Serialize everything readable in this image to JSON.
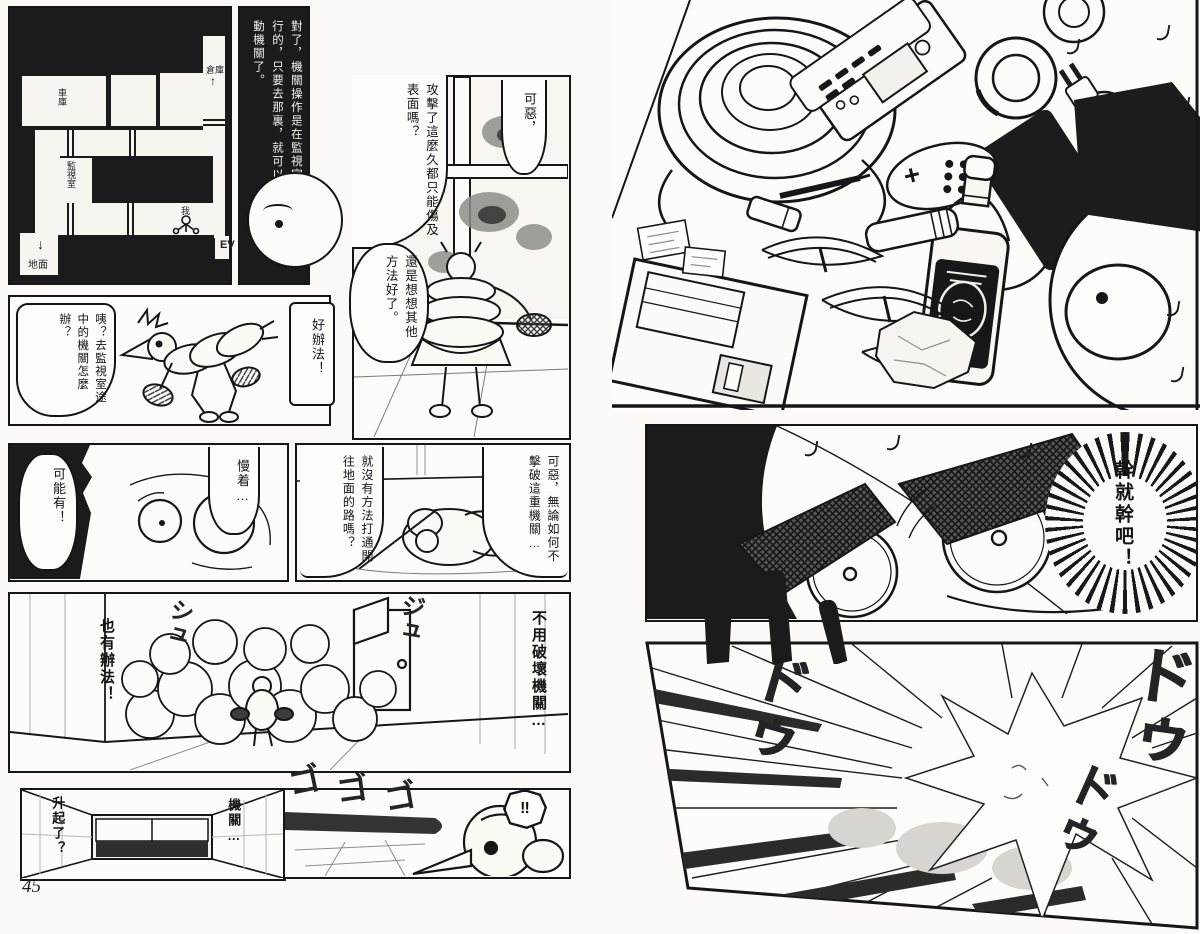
{
  "colors": {
    "ink": "#161616",
    "paper": "#fbfaf6",
    "panel_white": "#fcfcf8"
  },
  "page_number": "45",
  "left_page": {
    "map": {
      "garage": "車庫",
      "storage": "倉庫",
      "storage_arrow": "↑",
      "monitor_room": "監視室",
      "me": "我",
      "elevator": "EV",
      "down_arrow": "↓",
      "ground": "地面"
    },
    "narration": "對了，機關操作是在監視室進行的，只要去那裏，就可以開動機關了。",
    "bubble_damn": "可惡，",
    "bubble_attack": "攻擊了這麼久都只能傷及表面嗎？",
    "bubble_think": "還是想想其他方法好了。",
    "bubble_eh": "咦？去監視室途中的機關怎麼辦？",
    "bubble_idea": "好辦法！",
    "bubble_maybe": "可能有！",
    "bubble_wait": "慢着…",
    "bubble_path": "就沒有方法打通開往地面的路嗎？",
    "bubble_damn2": "可惡，無論如何不擊破這重機關…",
    "text_also_way": "也有辦法！",
    "text_no_destroy": "不用破壞機關…",
    "text_rising": "升起了？",
    "text_kikan": "機關…",
    "bubble_surprise": "‼",
    "sfx_shu1": "シュ",
    "sfx_shu2": "ジュ",
    "sfx_go1": "ゴ",
    "sfx_go2": "ゴ",
    "sfx_go3": "ゴ"
  },
  "right_page": {
    "bubble_resolve": "幹就幹吧！",
    "sfx_dou1": "ドゥ",
    "sfx_dou2": "ドゥ",
    "sfx_dou3": "ドゥ"
  }
}
